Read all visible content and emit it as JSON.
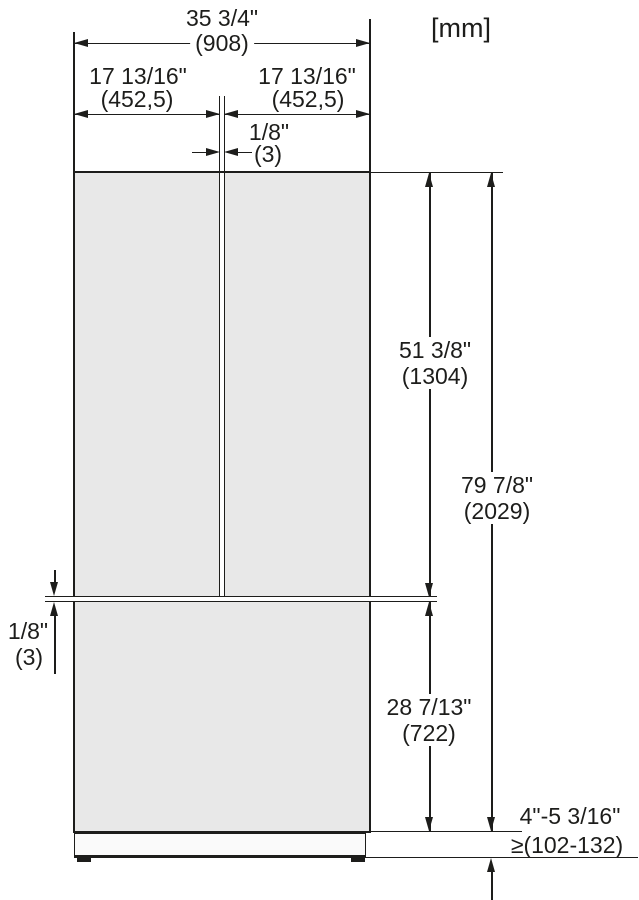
{
  "diagram": {
    "unit_note": "[mm]",
    "dimensions": {
      "overall_width": {
        "inches": "35 3/4\"",
        "mm": "(908)"
      },
      "left_door_width": {
        "inches": "17 13/16\"",
        "mm": "(452,5)"
      },
      "right_door_width": {
        "inches": "17 13/16\"",
        "mm": "(452,5)"
      },
      "door_gap_vertical": {
        "inches": "1/8\"",
        "mm": "(3)"
      },
      "door_gap_horizontal": {
        "inches": "1/8\"",
        "mm": "(3)"
      },
      "upper_section_height": {
        "inches": "51 3/8\"",
        "mm": "(1304)"
      },
      "overall_height": {
        "inches": "79 7/8\"",
        "mm": "(2029)"
      },
      "lower_section_height": {
        "inches": "28 7/13\"",
        "mm": "(722)"
      },
      "plinth_height": {
        "inches": "4\"-5 3/16\"",
        "mm": "≥(102-132)"
      }
    },
    "colors": {
      "line": "#1d1d1b",
      "body_fill": "#e8e8e8",
      "plinth_fill": "#fafafa",
      "background": "#ffffff"
    }
  }
}
